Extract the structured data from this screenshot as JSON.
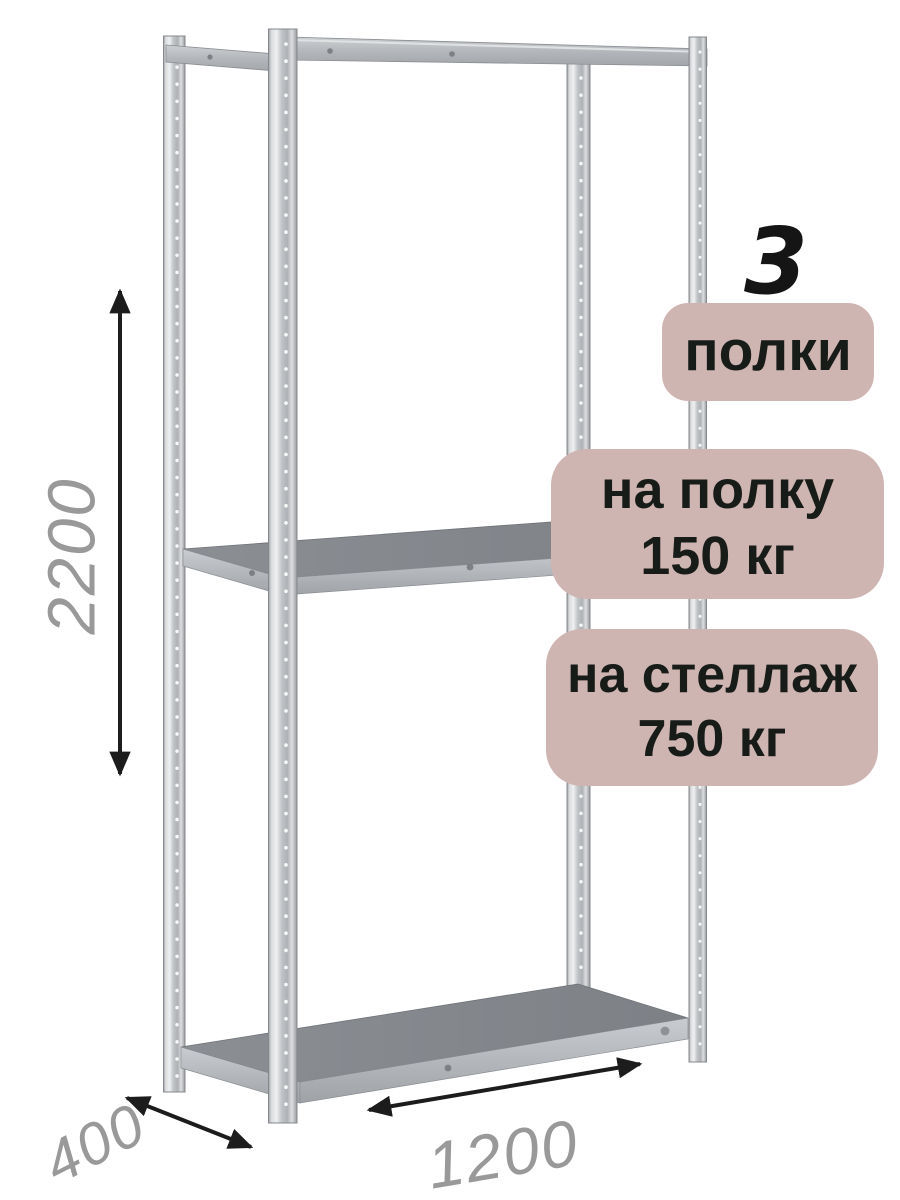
{
  "product": {
    "type_label": "стеллаж металлический",
    "shelf_count_value": "3",
    "shelf_count_label": "полки",
    "per_shelf_load": {
      "line1": "на полку",
      "line2": "150 кг"
    },
    "per_rack_load": {
      "line1": "на стеллаж",
      "line2": "750 кг"
    }
  },
  "dimensions": {
    "height": "2200",
    "depth": "400",
    "width": "1200"
  },
  "icons": [
    {
      "name": "height-arrow",
      "meaning": "vertical double-headed dimension arrow"
    },
    {
      "name": "depth-arrow",
      "meaning": "diagonal double-headed dimension arrow"
    },
    {
      "name": "width-arrow",
      "meaning": "diagonal double-headed dimension arrow"
    }
  ],
  "colors": {
    "badge_bg": "#cfb5b2",
    "badge_text": "#181c18",
    "dimension_text": "#999999",
    "arrow": "#1c1c1c",
    "metal_light": "#e8eaec",
    "metal_mid": "#b4b7bb",
    "metal_edge": "#8a8d91",
    "shelf_top": "#84888d",
    "background": "#ffffff"
  }
}
